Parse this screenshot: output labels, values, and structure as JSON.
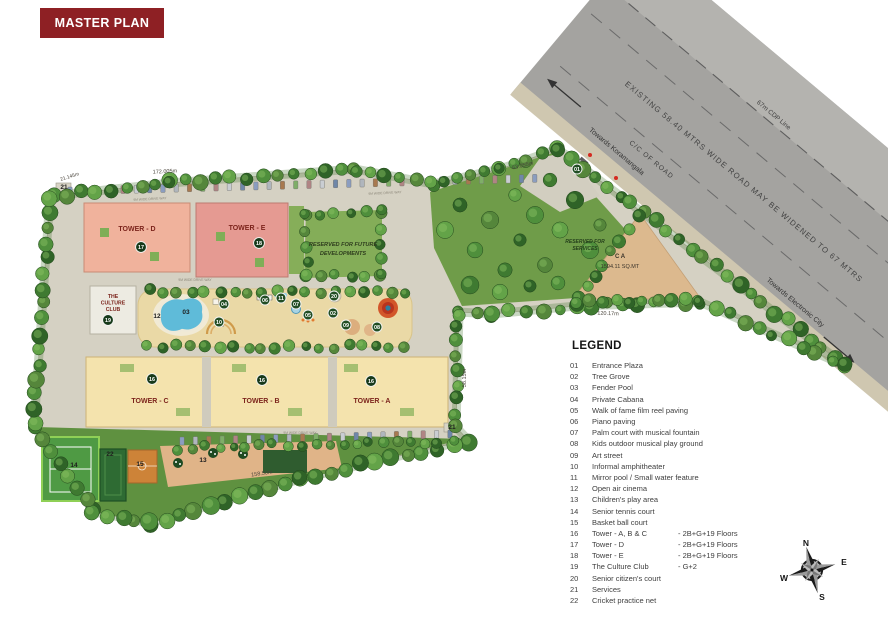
{
  "title": "MASTER PLAN",
  "colors": {
    "title_bg": "#8e2024",
    "road_gray": "#a4a3a0",
    "pool_blue": "#5fbbd9",
    "tower_d": "#f0b29c",
    "tower_e": "#e59a92",
    "towers_abc": "#f4e3ad",
    "grass": "#5f9140",
    "marker_green": "#224e24"
  },
  "road": {
    "label_main": "EXISTING 58.40 MTRS WIDE ROAD MAY BE WIDENED TO 67 MTRS",
    "label_cc": "C/C OF ROAD",
    "label_cdp": "67m CDP Line",
    "towards_left": "Towards Koramangala",
    "towards_right": "Towards Electronic City"
  },
  "plan": {
    "labels": {
      "tower_d": "TOWER - D",
      "tower_e": "TOWER - E",
      "tower_c": "TOWER - C",
      "tower_b": "TOWER - B",
      "tower_a": "TOWER - A",
      "culture_club_lines": [
        "THE",
        "CULTURE",
        "CLUB"
      ],
      "reserved_future_lines": [
        "RESERVED FOR FUTURE",
        "DEVELOPMENTS"
      ],
      "reserved_services_lines": [
        "RESERVED FOR",
        "SERVICES"
      ],
      "ca_lines": [
        "C A",
        "1594.11 SQ.MT"
      ],
      "driveway": "9M WIDE DRIVE WAY"
    },
    "dimensions": [
      "172.005m",
      "63.055m",
      "58.15m",
      "120.17m",
      "158.50m",
      "21.145m"
    ],
    "markers": [
      {
        "n": "01",
        "x": 577,
        "y": 169,
        "s": "c"
      },
      {
        "n": "02",
        "x": 333,
        "y": 313,
        "s": "c"
      },
      {
        "n": "03",
        "x": 186,
        "y": 314,
        "s": "t"
      },
      {
        "n": "04",
        "x": 224,
        "y": 304,
        "s": "c"
      },
      {
        "n": "05",
        "x": 308,
        "y": 315,
        "s": "c"
      },
      {
        "n": "06",
        "x": 265,
        "y": 300,
        "s": "c"
      },
      {
        "n": "07",
        "x": 296,
        "y": 304,
        "s": "c"
      },
      {
        "n": "08",
        "x": 377,
        "y": 327,
        "s": "c"
      },
      {
        "n": "09",
        "x": 346,
        "y": 325,
        "s": "c"
      },
      {
        "n": "10",
        "x": 219,
        "y": 322,
        "s": "c"
      },
      {
        "n": "11",
        "x": 281,
        "y": 298,
        "s": "c"
      },
      {
        "n": "12",
        "x": 157,
        "y": 318,
        "s": "t"
      },
      {
        "n": "13",
        "x": 203,
        "y": 462,
        "s": "t"
      },
      {
        "n": "14",
        "x": 74,
        "y": 467,
        "s": "t"
      },
      {
        "n": "15",
        "x": 140,
        "y": 466,
        "s": "t"
      },
      {
        "n": "16",
        "x": 152,
        "y": 379,
        "s": "d"
      },
      {
        "n": "16",
        "x": 262,
        "y": 380,
        "s": "d"
      },
      {
        "n": "16",
        "x": 371,
        "y": 381,
        "s": "d"
      },
      {
        "n": "17",
        "x": 141,
        "y": 247,
        "s": "d"
      },
      {
        "n": "18",
        "x": 259,
        "y": 243,
        "s": "d"
      },
      {
        "n": "19",
        "x": 108,
        "y": 320,
        "s": "d"
      },
      {
        "n": "20",
        "x": 334,
        "y": 296,
        "s": "c"
      },
      {
        "n": "21",
        "x": 64,
        "y": 189,
        "s": "t"
      },
      {
        "n": "21",
        "x": 452,
        "y": 429,
        "s": "t"
      },
      {
        "n": "22",
        "x": 110,
        "y": 456,
        "s": "t"
      }
    ]
  },
  "legend": {
    "title": "LEGEND",
    "items": [
      {
        "num": "01",
        "name": "Entrance Plaza",
        "suffix": ""
      },
      {
        "num": "02",
        "name": "Tree Grove",
        "suffix": ""
      },
      {
        "num": "03",
        "name": "Fender Pool",
        "suffix": ""
      },
      {
        "num": "04",
        "name": "Private Cabana",
        "suffix": ""
      },
      {
        "num": "05",
        "name": "Walk of fame film reel paving",
        "suffix": ""
      },
      {
        "num": "06",
        "name": "Piano paving",
        "suffix": ""
      },
      {
        "num": "07",
        "name": "Palm court with musical fountain",
        "suffix": ""
      },
      {
        "num": "08",
        "name": "Kids outdoor musical play ground",
        "suffix": ""
      },
      {
        "num": "09",
        "name": "Art street",
        "suffix": ""
      },
      {
        "num": "10",
        "name": "Informal amphitheater",
        "suffix": ""
      },
      {
        "num": "11",
        "name": "Mirror pool / Small water feature",
        "suffix": ""
      },
      {
        "num": "12",
        "name": "Open air cinema",
        "suffix": ""
      },
      {
        "num": "13",
        "name": "Children's play area",
        "suffix": ""
      },
      {
        "num": "14",
        "name": "Senior tennis court",
        "suffix": ""
      },
      {
        "num": "15",
        "name": "Basket ball court",
        "suffix": ""
      },
      {
        "num": "16",
        "name": "Tower - A, B & C",
        "suffix": "- 2B+G+19 Floors"
      },
      {
        "num": "17",
        "name": "Tower - D",
        "suffix": "- 2B+G+19 Floors"
      },
      {
        "num": "18",
        "name": "Tower - E",
        "suffix": "- 2B+G+19 Floors"
      },
      {
        "num": "19",
        "name": "The Culture Club",
        "suffix": "- G+2"
      },
      {
        "num": "20",
        "name": "Senior citizen's court",
        "suffix": ""
      },
      {
        "num": "21",
        "name": "Services",
        "suffix": ""
      },
      {
        "num": "22",
        "name": "Cricket practice net",
        "suffix": ""
      }
    ]
  },
  "compass": {
    "n": "N",
    "e": "E",
    "s": "S",
    "w": "W"
  }
}
